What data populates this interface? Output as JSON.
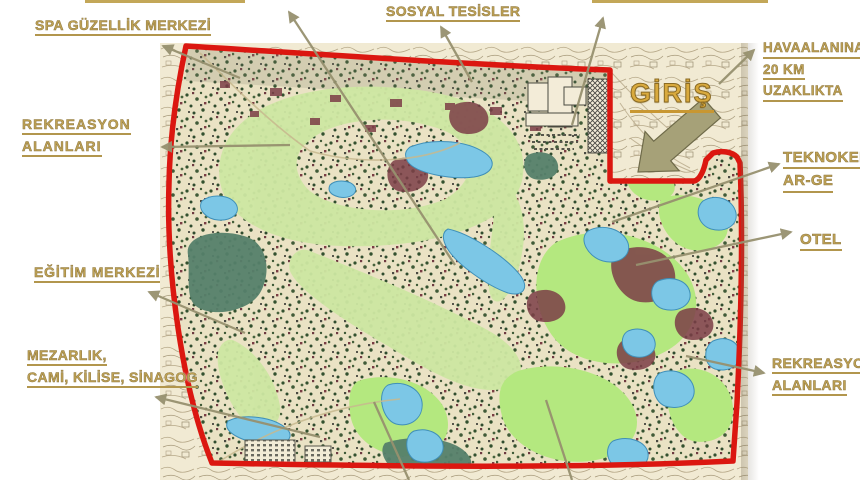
{
  "labels": {
    "spa": "SPA GÜZELLİK MERKEZİ",
    "rekreasyon_left": {
      "line1": "REKREASYON",
      "line2": "ALANLARI"
    },
    "egitim": "EĞİTİM MERKEZİ",
    "mezarlik": {
      "line1": "MEZARLIK,",
      "line2": "CAMİ, KİLİSE, SİNAGOG"
    },
    "sosyal": "SOSYAL TESİSLER",
    "havaalani": {
      "line1": "HAVAALANINA",
      "line2": "20 KM",
      "line3": "UZAKLIKTA"
    },
    "giris": "GİRİŞ",
    "teknokent": {
      "line1": "TEKNOKENT",
      "line2": "AR-GE"
    },
    "otel": "OTEL",
    "rekreasyon_right": {
      "line1": "REKREASYON",
      "line2": "ALANLARI"
    }
  },
  "map": {
    "kind": "masterplan-site-map",
    "entrance_label": "GİRİŞ"
  },
  "colors": {
    "label_gold": "#bfa255",
    "giris_gold": "#d9aa3e",
    "arrow_olive": "#97916f",
    "boundary_red": "#db1710",
    "paper_beige": "#f1ead3",
    "golf_green": "#cde7a2",
    "bright_green": "#b4e87f",
    "water_blue": "#7cc7e6",
    "forest_green": "#55806a",
    "building_maroon": "#7c3e47"
  }
}
